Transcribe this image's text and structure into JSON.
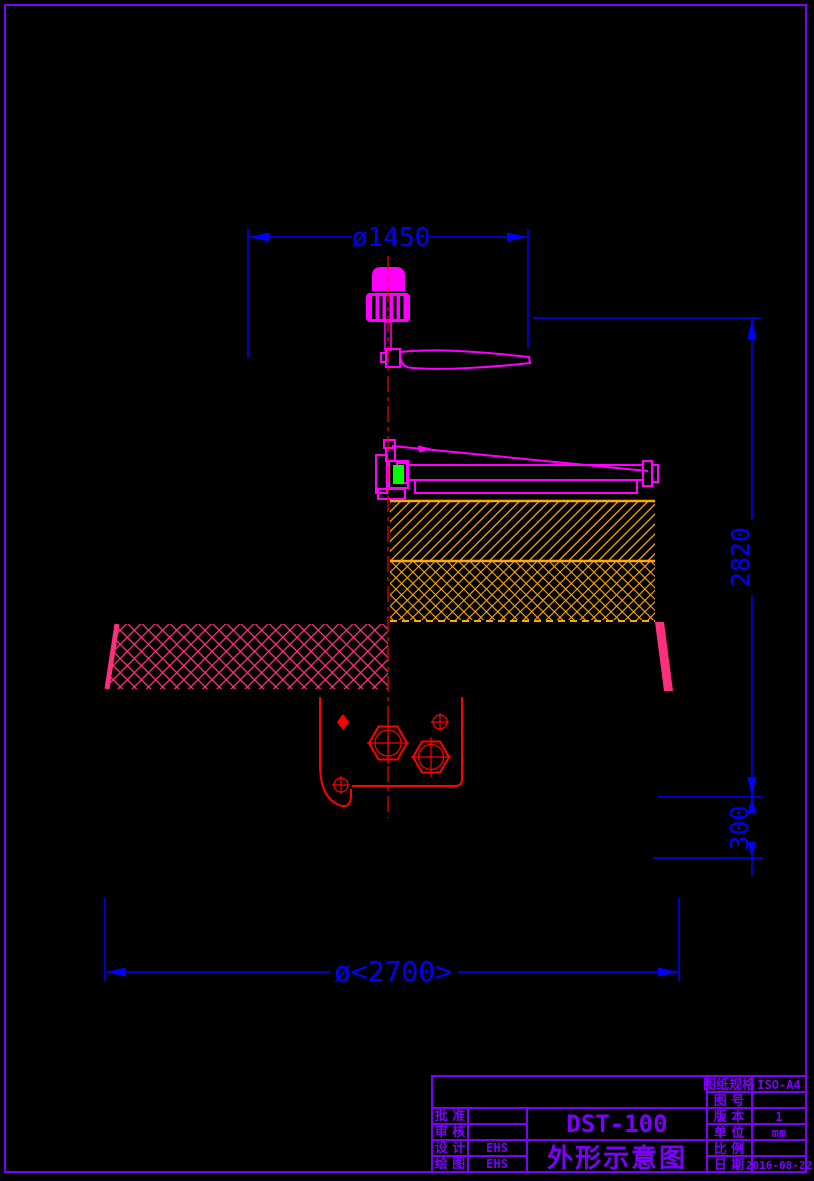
{
  "drawing": {
    "dimensions": {
      "top_diameter": "ø1450",
      "total_height": "2820",
      "base_height": "300",
      "bottom_diameter": "ø<2700>"
    },
    "title_block": {
      "model": "DST-100",
      "drawing_title": "外形示意图",
      "left_rows": [
        {
          "label": "批 准",
          "value": ""
        },
        {
          "label": "审 核",
          "value": ""
        },
        {
          "label": "设 计",
          "value": "EHS"
        },
        {
          "label": "绘 图",
          "value": "EHS"
        }
      ],
      "right_rows": [
        {
          "label": "图纸规格",
          "value": "ISO-A4"
        },
        {
          "label": "图 号",
          "value": ""
        },
        {
          "label": "版 本",
          "value": "1"
        },
        {
          "label": "单 位",
          "value": "mm"
        },
        {
          "label": "比 例",
          "value": ""
        },
        {
          "label": "日 期",
          "value": "2016-08-22"
        }
      ]
    },
    "colors": {
      "background": "#000000",
      "frame_border": "#7D00FF",
      "dimension": "#0000FF",
      "machine": "#FF00FF",
      "float_hatch": "#FFAA00",
      "tank_hatch": "#FF2F7F",
      "anchor_bracket": "#FF0000",
      "centerline": "#FF0000",
      "indicator_green": "#00FF00"
    }
  }
}
